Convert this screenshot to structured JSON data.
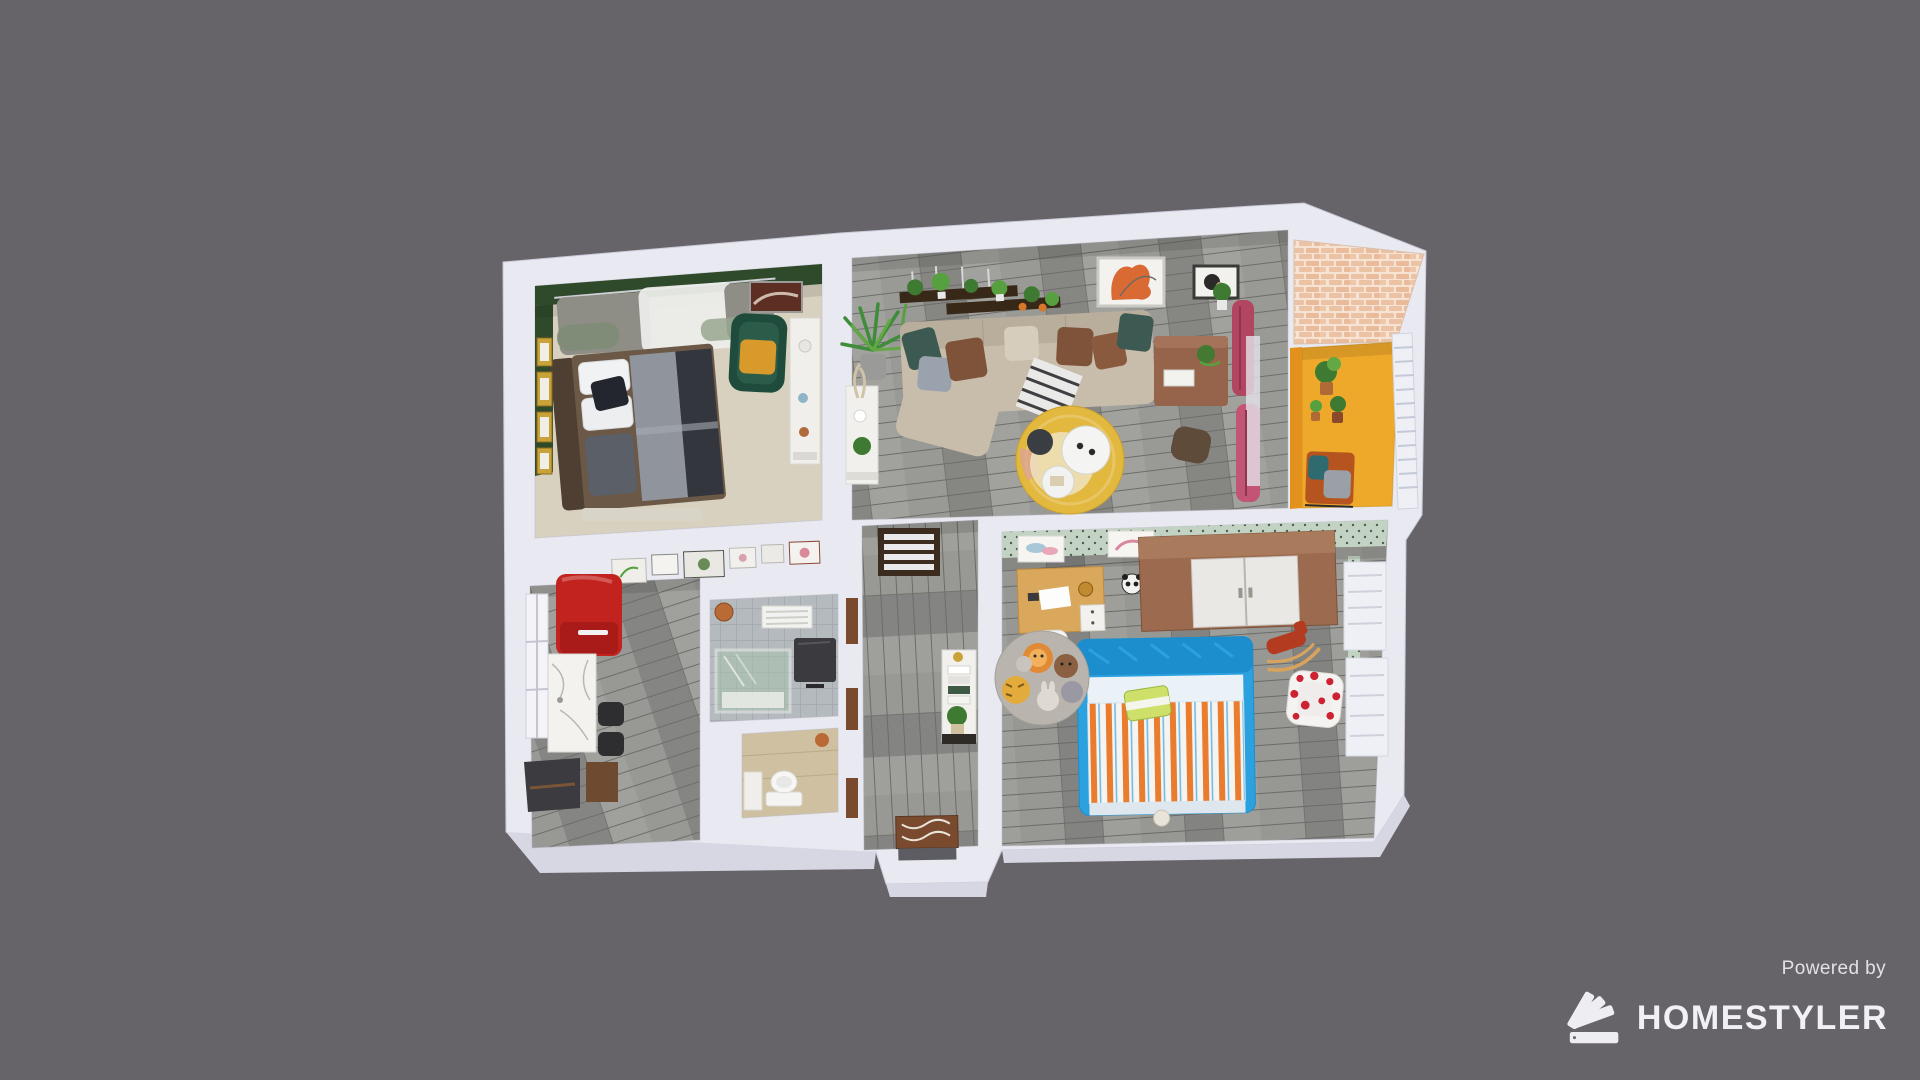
{
  "canvas": {
    "width": 1920,
    "height": 1080,
    "background": "#666468"
  },
  "branding": {
    "powered_by": "Powered by",
    "brand": "HOMESTYLER",
    "logo_icon": "homestyler-swatch-fan-icon",
    "text_color": "#f1f0f4"
  },
  "palette": {
    "bg": "#666468",
    "wall": "#e9e9f2",
    "wallShade": "#d7d7e4",
    "textLight": "#eceaef",
    "bedroomGreen": "#2f4a2b",
    "bedroomFloor": "#d8d1c0",
    "plankBase": "#8f8f8d",
    "balconyYellow": "#efa92a",
    "balconyWallYellow": "#e2921c",
    "brick": "#ecc2a4",
    "sofaBeige": "#c8bdab",
    "pillowBrown": "#7e5339",
    "pillowTeal": "#3c5a52",
    "rugYellow": "#e2b83e",
    "curtainPink": "#b24560",
    "fridgeRed": "#c2231f",
    "marble": "#f3f2ee",
    "kidBlue": "#2ba1df",
    "duvetOrange": "#e97c2e",
    "wardrobeWood": "#9b6a4f",
    "deskWood": "#d9a85c",
    "wallpaperGreen": "#c3d3c3",
    "heartRed": "#cc2231",
    "hallCabinet": "#3c2b1f",
    "doorBrown": "#7a4a2e",
    "plantGreen": "#3f7a33",
    "gold": "#c9a23a"
  },
  "scene": {
    "type": "3d-floorplan-render",
    "rooms": [
      {
        "id": "master-bedroom",
        "accent_wall": "bedroomGreen",
        "floor": "bedroomFloor",
        "items": [
          "double-bed",
          "window-curtains",
          "green-armchair",
          "dresser",
          "gold-wall-frames",
          "wall-art"
        ]
      },
      {
        "id": "living-room",
        "floor": "gray-plank",
        "items": [
          "sectional-sofa",
          "wall-shelves-with-plants",
          "wall-art-orange",
          "wall-art-small",
          "palm-plant",
          "console-table",
          "round-yellow-rug",
          "coffee-tables",
          "wood-side-table",
          "pouf",
          "pink-curtains"
        ]
      },
      {
        "id": "balcony",
        "floor": "balconyYellow",
        "items": [
          "brick-wall",
          "white-railing",
          "potted-plants",
          "outdoor-bench"
        ]
      },
      {
        "id": "kitchen",
        "floor": "gray-plank",
        "items": [
          "red-refrigerator",
          "marble-counter",
          "bar-stools",
          "picture-frame-row",
          "window",
          "wood-cabinet",
          "storage-closet"
        ]
      },
      {
        "id": "shower-room",
        "floor": "gray-tile",
        "items": [
          "glass-shower",
          "towel-rack",
          "copper-pot",
          "dark-storage-unit"
        ]
      },
      {
        "id": "wc",
        "floor": "wood-beige",
        "items": [
          "toilet",
          "vanity",
          "copper-pot"
        ]
      },
      {
        "id": "hallway",
        "floor": "gray-plank",
        "items": [
          "shoe-cabinet",
          "console-table-books",
          "entry-door"
        ]
      },
      {
        "id": "kids-room",
        "accent_wall": "wallpaperGreen",
        "floor": "gray-plank",
        "items": [
          "wood-wardrobe",
          "kids-bed-blue",
          "animal-round-rug",
          "kids-desk",
          "rocking-horse",
          "heart-armchair",
          "panda-plush",
          "pastel-wall-art",
          "white-panels"
        ]
      }
    ]
  }
}
